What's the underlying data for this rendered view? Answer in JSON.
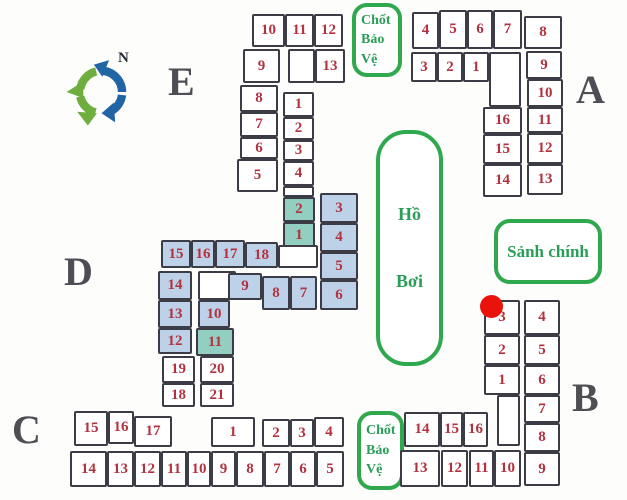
{
  "colors": {
    "room_border": "#3c3c46",
    "room_number": "#b23240",
    "room_fill_white": "#ffffff",
    "room_fill_blue": "#bdd1e8",
    "room_fill_teal": "#92cfc0",
    "section_label": "#4e4e54",
    "green_border": "#2fa84e",
    "green_text": "#2a9e58",
    "red_dot": "#ea130b",
    "compass_green": "#6fae3e",
    "compass_blue": "#2265a5"
  },
  "landmarks": {
    "guard_top": {
      "line1": "Chốt",
      "line2": "Bảo",
      "line3": "Vệ"
    },
    "guard_bottom": {
      "line1": "Chốt",
      "line2": "Bảo",
      "line3": "Vệ"
    },
    "pool": {
      "line1": "Hồ",
      "line2": "Bơi"
    },
    "lobby": {
      "text": "Sảnh chính"
    },
    "compass": {
      "north_label": "N"
    }
  },
  "sections": [
    {
      "id": "E",
      "label": "E",
      "x": 168,
      "y": 62
    },
    {
      "id": "A",
      "label": "A",
      "x": 576,
      "y": 70
    },
    {
      "id": "D",
      "label": "D",
      "x": 64,
      "y": 252
    },
    {
      "id": "C",
      "label": "C",
      "x": 12,
      "y": 410
    },
    {
      "id": "B",
      "label": "B",
      "x": 572,
      "y": 378
    }
  ],
  "rooms": [
    {
      "s": "E",
      "n": "10",
      "x": 252,
      "y": 14,
      "w": 33,
      "h": 33,
      "f": "w"
    },
    {
      "s": "E",
      "n": "11",
      "x": 285,
      "y": 14,
      "w": 29,
      "h": 33,
      "f": "w"
    },
    {
      "s": "E",
      "n": "12",
      "x": 314,
      "y": 14,
      "w": 29,
      "h": 33,
      "f": "w"
    },
    {
      "s": "E",
      "n": "9",
      "x": 243,
      "y": 49,
      "w": 37,
      "h": 34,
      "f": "w"
    },
    {
      "s": "E",
      "n": "",
      "x": 288,
      "y": 49,
      "w": 27,
      "h": 34,
      "f": "w"
    },
    {
      "s": "E",
      "n": "13",
      "x": 315,
      "y": 49,
      "w": 30,
      "h": 34,
      "f": "w"
    },
    {
      "s": "E",
      "n": "8",
      "x": 240,
      "y": 85,
      "w": 38,
      "h": 27,
      "f": "w"
    },
    {
      "s": "E",
      "n": "7",
      "x": 240,
      "y": 112,
      "w": 38,
      "h": 25,
      "f": "w"
    },
    {
      "s": "E",
      "n": "6",
      "x": 240,
      "y": 137,
      "w": 38,
      "h": 22,
      "f": "w"
    },
    {
      "s": "E",
      "n": "5",
      "x": 237,
      "y": 159,
      "w": 41,
      "h": 33,
      "f": "w"
    },
    {
      "s": "E",
      "n": "1",
      "x": 283,
      "y": 92,
      "w": 31,
      "h": 25,
      "f": "w"
    },
    {
      "s": "E",
      "n": "2",
      "x": 283,
      "y": 117,
      "w": 31,
      "h": 23,
      "f": "w"
    },
    {
      "s": "E",
      "n": "3",
      "x": 283,
      "y": 140,
      "w": 31,
      "h": 21,
      "f": "w"
    },
    {
      "s": "E",
      "n": "4",
      "x": 283,
      "y": 161,
      "w": 31,
      "h": 25,
      "f": "w"
    },
    {
      "s": "E",
      "n": "",
      "x": 283,
      "y": 186,
      "w": 31,
      "h": 11,
      "f": "w"
    },
    {
      "s": "A",
      "n": "4",
      "x": 412,
      "y": 12,
      "w": 27,
      "h": 37,
      "f": "w"
    },
    {
      "s": "A",
      "n": "5",
      "x": 439,
      "y": 10,
      "w": 28,
      "h": 39,
      "f": "w"
    },
    {
      "s": "A",
      "n": "6",
      "x": 467,
      "y": 10,
      "w": 26,
      "h": 39,
      "f": "w"
    },
    {
      "s": "A",
      "n": "7",
      "x": 493,
      "y": 10,
      "w": 29,
      "h": 39,
      "f": "w"
    },
    {
      "s": "A",
      "n": "8",
      "x": 524,
      "y": 16,
      "w": 38,
      "h": 33,
      "f": "w"
    },
    {
      "s": "A",
      "n": "3",
      "x": 411,
      "y": 52,
      "w": 26,
      "h": 30,
      "f": "w"
    },
    {
      "s": "A",
      "n": "2",
      "x": 437,
      "y": 52,
      "w": 26,
      "h": 30,
      "f": "w"
    },
    {
      "s": "A",
      "n": "1",
      "x": 463,
      "y": 52,
      "w": 26,
      "h": 30,
      "f": "w"
    },
    {
      "s": "A",
      "n": "",
      "x": 489,
      "y": 52,
      "w": 32,
      "h": 55,
      "f": "w"
    },
    {
      "s": "A",
      "n": "9",
      "x": 526,
      "y": 51,
      "w": 36,
      "h": 28,
      "f": "w"
    },
    {
      "s": "A",
      "n": "10",
      "x": 527,
      "y": 79,
      "w": 36,
      "h": 28,
      "f": "w"
    },
    {
      "s": "A",
      "n": "11",
      "x": 527,
      "y": 107,
      "w": 36,
      "h": 26,
      "f": "w"
    },
    {
      "s": "A",
      "n": "16",
      "x": 483,
      "y": 107,
      "w": 39,
      "h": 27,
      "f": "w"
    },
    {
      "s": "A",
      "n": "12",
      "x": 527,
      "y": 133,
      "w": 36,
      "h": 31,
      "f": "w"
    },
    {
      "s": "A",
      "n": "15",
      "x": 483,
      "y": 134,
      "w": 39,
      "h": 30,
      "f": "w"
    },
    {
      "s": "A",
      "n": "13",
      "x": 527,
      "y": 164,
      "w": 36,
      "h": 31,
      "f": "w"
    },
    {
      "s": "A",
      "n": "14",
      "x": 483,
      "y": 164,
      "w": 39,
      "h": 33,
      "f": "w"
    },
    {
      "s": "D",
      "n": "2",
      "x": 283,
      "y": 197,
      "w": 32,
      "h": 25,
      "f": "t"
    },
    {
      "s": "D",
      "n": "1",
      "x": 283,
      "y": 222,
      "w": 32,
      "h": 26,
      "f": "t"
    },
    {
      "s": "D",
      "n": "3",
      "x": 320,
      "y": 193,
      "w": 38,
      "h": 30,
      "f": "b"
    },
    {
      "s": "D",
      "n": "4",
      "x": 320,
      "y": 223,
      "w": 38,
      "h": 29,
      "f": "b"
    },
    {
      "s": "D",
      "n": "5",
      "x": 320,
      "y": 252,
      "w": 38,
      "h": 28,
      "f": "b"
    },
    {
      "s": "D",
      "n": "6",
      "x": 320,
      "y": 280,
      "w": 38,
      "h": 30,
      "f": "b"
    },
    {
      "s": "D",
      "n": "15",
      "x": 161,
      "y": 240,
      "w": 30,
      "h": 28,
      "f": "b"
    },
    {
      "s": "D",
      "n": "16",
      "x": 191,
      "y": 240,
      "w": 24,
      "h": 28,
      "f": "b"
    },
    {
      "s": "D",
      "n": "17",
      "x": 215,
      "y": 240,
      "w": 30,
      "h": 28,
      "f": "b"
    },
    {
      "s": "D",
      "n": "18",
      "x": 245,
      "y": 242,
      "w": 33,
      "h": 26,
      "f": "b"
    },
    {
      "s": "D",
      "n": "",
      "x": 278,
      "y": 245,
      "w": 40,
      "h": 23,
      "f": "w"
    },
    {
      "s": "D",
      "n": "14",
      "x": 158,
      "y": 271,
      "w": 34,
      "h": 29,
      "f": "b"
    },
    {
      "s": "D",
      "n": "13",
      "x": 158,
      "y": 300,
      "w": 34,
      "h": 28,
      "f": "b"
    },
    {
      "s": "D",
      "n": "12",
      "x": 158,
      "y": 328,
      "w": 34,
      "h": 26,
      "f": "b"
    },
    {
      "s": "D",
      "n": "",
      "x": 198,
      "y": 271,
      "w": 38,
      "h": 29,
      "f": "w"
    },
    {
      "s": "D",
      "n": "10",
      "x": 198,
      "y": 300,
      "w": 32,
      "h": 28,
      "f": "b"
    },
    {
      "s": "D",
      "n": "11",
      "x": 196,
      "y": 328,
      "w": 38,
      "h": 28,
      "f": "t"
    },
    {
      "s": "D",
      "n": "9",
      "x": 228,
      "y": 273,
      "w": 34,
      "h": 27,
      "f": "b"
    },
    {
      "s": "D",
      "n": "8",
      "x": 262,
      "y": 276,
      "w": 28,
      "h": 34,
      "f": "b"
    },
    {
      "s": "D",
      "n": "7",
      "x": 290,
      "y": 276,
      "w": 27,
      "h": 34,
      "f": "b"
    },
    {
      "s": "D",
      "n": "19",
      "x": 162,
      "y": 356,
      "w": 33,
      "h": 27,
      "f": "w"
    },
    {
      "s": "D",
      "n": "20",
      "x": 200,
      "y": 356,
      "w": 34,
      "h": 27,
      "f": "w"
    },
    {
      "s": "D",
      "n": "18",
      "x": 162,
      "y": 383,
      "w": 33,
      "h": 24,
      "f": "w"
    },
    {
      "s": "D",
      "n": "21",
      "x": 200,
      "y": 383,
      "w": 34,
      "h": 24,
      "f": "w"
    },
    {
      "s": "C",
      "n": "15",
      "x": 74,
      "y": 411,
      "w": 34,
      "h": 35,
      "f": "w"
    },
    {
      "s": "C",
      "n": "16",
      "x": 108,
      "y": 411,
      "w": 26,
      "h": 33,
      "f": "w"
    },
    {
      "s": "C",
      "n": "17",
      "x": 134,
      "y": 416,
      "w": 38,
      "h": 31,
      "f": "w"
    },
    {
      "s": "C",
      "n": "1",
      "x": 211,
      "y": 417,
      "w": 44,
      "h": 30,
      "f": "w"
    },
    {
      "s": "C",
      "n": "2",
      "x": 262,
      "y": 419,
      "w": 28,
      "h": 28,
      "f": "w"
    },
    {
      "s": "C",
      "n": "3",
      "x": 290,
      "y": 419,
      "w": 24,
      "h": 28,
      "f": "w"
    },
    {
      "s": "C",
      "n": "4",
      "x": 314,
      "y": 417,
      "w": 30,
      "h": 30,
      "f": "w"
    },
    {
      "s": "C",
      "n": "14",
      "x": 70,
      "y": 451,
      "w": 37,
      "h": 36,
      "f": "w"
    },
    {
      "s": "C",
      "n": "13",
      "x": 107,
      "y": 451,
      "w": 27,
      "h": 36,
      "f": "w"
    },
    {
      "s": "C",
      "n": "12",
      "x": 134,
      "y": 451,
      "w": 27,
      "h": 36,
      "f": "w"
    },
    {
      "s": "C",
      "n": "11",
      "x": 161,
      "y": 451,
      "w": 26,
      "h": 36,
      "f": "w"
    },
    {
      "s": "C",
      "n": "10",
      "x": 187,
      "y": 451,
      "w": 24,
      "h": 36,
      "f": "w"
    },
    {
      "s": "C",
      "n": "9",
      "x": 211,
      "y": 451,
      "w": 25,
      "h": 36,
      "f": "w"
    },
    {
      "s": "C",
      "n": "8",
      "x": 236,
      "y": 451,
      "w": 28,
      "h": 36,
      "f": "w"
    },
    {
      "s": "C",
      "n": "7",
      "x": 264,
      "y": 451,
      "w": 26,
      "h": 36,
      "f": "w"
    },
    {
      "s": "C",
      "n": "6",
      "x": 290,
      "y": 451,
      "w": 26,
      "h": 36,
      "f": "w"
    },
    {
      "s": "C",
      "n": "5",
      "x": 316,
      "y": 451,
      "w": 28,
      "h": 36,
      "f": "w"
    },
    {
      "s": "B",
      "n": "3",
      "x": 484,
      "y": 300,
      "w": 36,
      "h": 35,
      "f": "w"
    },
    {
      "s": "B",
      "n": "2",
      "x": 484,
      "y": 335,
      "w": 36,
      "h": 30,
      "f": "w"
    },
    {
      "s": "B",
      "n": "1",
      "x": 484,
      "y": 365,
      "w": 36,
      "h": 30,
      "f": "w"
    },
    {
      "s": "B",
      "n": "",
      "x": 497,
      "y": 395,
      "w": 23,
      "h": 51,
      "f": "w"
    },
    {
      "s": "B",
      "n": "4",
      "x": 524,
      "y": 300,
      "w": 36,
      "h": 35,
      "f": "w"
    },
    {
      "s": "B",
      "n": "5",
      "x": 524,
      "y": 335,
      "w": 36,
      "h": 30,
      "f": "w"
    },
    {
      "s": "B",
      "n": "6",
      "x": 524,
      "y": 365,
      "w": 36,
      "h": 30,
      "f": "w"
    },
    {
      "s": "B",
      "n": "7",
      "x": 524,
      "y": 395,
      "w": 36,
      "h": 28,
      "f": "w"
    },
    {
      "s": "B",
      "n": "8",
      "x": 524,
      "y": 423,
      "w": 36,
      "h": 29,
      "f": "w"
    },
    {
      "s": "B",
      "n": "9",
      "x": 524,
      "y": 452,
      "w": 36,
      "h": 34,
      "f": "w"
    },
    {
      "s": "B",
      "n": "14",
      "x": 404,
      "y": 412,
      "w": 36,
      "h": 35,
      "f": "w"
    },
    {
      "s": "B",
      "n": "15",
      "x": 440,
      "y": 412,
      "w": 23,
      "h": 35,
      "f": "w"
    },
    {
      "s": "B",
      "n": "16",
      "x": 463,
      "y": 412,
      "w": 25,
      "h": 35,
      "f": "w"
    },
    {
      "s": "B",
      "n": "13",
      "x": 400,
      "y": 450,
      "w": 40,
      "h": 37,
      "f": "w"
    },
    {
      "s": "B",
      "n": "12",
      "x": 441,
      "y": 450,
      "w": 27,
      "h": 37,
      "f": "w"
    },
    {
      "s": "B",
      "n": "11",
      "x": 469,
      "y": 450,
      "w": 25,
      "h": 37,
      "f": "w"
    },
    {
      "s": "B",
      "n": "10",
      "x": 494,
      "y": 450,
      "w": 27,
      "h": 37,
      "f": "w"
    }
  ],
  "marker": {
    "x": 480,
    "y": 295
  }
}
